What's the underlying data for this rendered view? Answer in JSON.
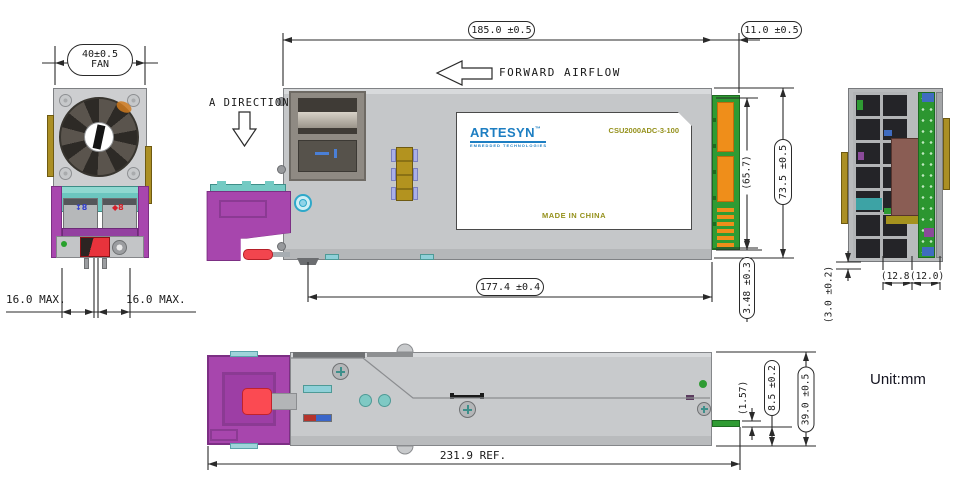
{
  "unit_label": "Unit:mm",
  "front_view": {
    "fan_dim": "40±0.5",
    "fan_dim_sub": "FAN",
    "dim_left": "16.0 MAX.",
    "dim_right": "16.0 MAX.",
    "port_marks": [
      "↕8",
      "◆8"
    ]
  },
  "side_view": {
    "direction_label": "A DIRECTION",
    "airflow_label": "FORWARD AIRFLOW",
    "dim_length": "185.0 ±0.5",
    "dim_connector": "11.0 ±0.5",
    "dim_height": "73.5 ±0.5",
    "dim_pad_height": "(65.7)",
    "dim_offset": "3.48 ±0.3",
    "dim_body": "177.4 ±0.4",
    "label": {
      "brand": "ARTESYN",
      "trademark": "™",
      "tagline": "EMBEDDED TECHNOLOGIES",
      "model": "CSU2000ADC-3-100",
      "origin": "MADE IN CHINA"
    }
  },
  "rear_view": {
    "dim_edge": "(3.0 ±0.2)",
    "dim_inner": "(12.8)",
    "dim_outer": "(12.0)"
  },
  "bottom_view": {
    "dim_total": "231.9 REF.",
    "dim_tab": "(1.57)",
    "dim_tab_offset": "8.5 ±0.2",
    "dim_height": "39.0 ±0.5"
  },
  "colors": {
    "body_gray": "#c5c7c9",
    "handle_purple": "#a746ad",
    "latch_red": "#ee3a44",
    "connector_green": "#2f9b33",
    "pad_orange": "#ef8e1a",
    "accent_teal": "#74cac3",
    "brand_blue": "#1d7ec2",
    "label_olive": "#95911c",
    "line_dark": "#2a2a2a"
  }
}
